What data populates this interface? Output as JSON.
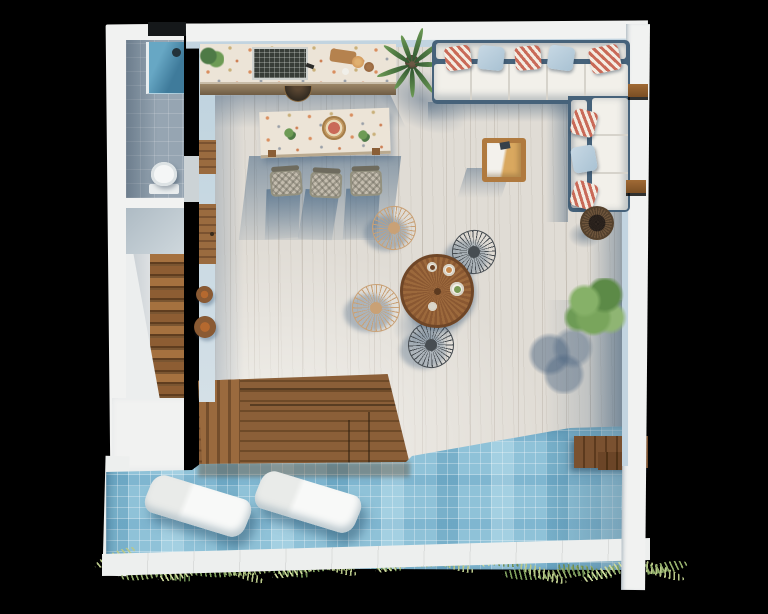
{
  "scene": {
    "title": "rooftop-terrace-floor-plan-render",
    "style": "top-down 3d architectural render on black background",
    "rooms": [
      "bathroom",
      "stairwell",
      "terrace",
      "pool"
    ],
    "objects": [
      "shower",
      "toilet",
      "staircase",
      "outdoor-kitchen-counter",
      "grill",
      "bar-table",
      "bar-stools",
      "l-shaped-sofa",
      "striped-pillows",
      "wood-armchair",
      "round-dining-table",
      "wire-fan-chairs",
      "basket-planter",
      "tree",
      "palm-plant",
      "deck-steps",
      "mosaic-pool",
      "pool-loungers",
      "pool-bench",
      "palm-fronds"
    ]
  },
  "palette": {
    "black": "#000000",
    "wall": "#f1f2f1",
    "wallFace": "#c2d4e0",
    "floor": "#e0dcd5",
    "bathFloor": "#96a5b2",
    "showerTeal": "#3f7b9b",
    "toilet": "#f4f6f6",
    "stairWood": "#a5713f",
    "doorWood": "#9a6b3f",
    "terrazzo": "#ece4d7",
    "grill": "#383d38",
    "sofaBase": "#46627a",
    "cushion": "#f2f0ea",
    "stripeRed": "#c96a58",
    "pillowBlue": "#a9c2d3",
    "armTan": "#d9a85f",
    "stoolGray": "#c3bcae",
    "tableWood": "#8a5832",
    "chairTan": "#c9a176",
    "chairDark": "#474d52",
    "treeGreen": "#79a55c",
    "basket": "#2f2620",
    "deck": "#8b5f38",
    "poolBase": "#8fc2d8",
    "benchWood": "#7a5130",
    "curb": "#edefee"
  },
  "build": {
    "stair_treads": {
      "count": 12,
      "step": 12,
      "height": 10
    },
    "palm_fronds": {
      "count": 9,
      "base_len": 26
    },
    "sofa_pillows_h": [
      {
        "x": 13,
        "t": "stripe",
        "rot": -8
      },
      {
        "x": 46,
        "t": "plain",
        "rot": 6
      },
      {
        "x": 83,
        "t": "stripe",
        "rot": -5
      },
      {
        "x": 116,
        "t": "plain",
        "rot": 8
      },
      {
        "x": 158,
        "t": "stripe",
        "rot": -12,
        "w": 30,
        "h": 26
      }
    ],
    "sofa_pillows_v": [
      {
        "y": 14,
        "t": "stripe",
        "rot": 14
      },
      {
        "y": 50,
        "t": "plain",
        "rot": -10
      },
      {
        "y": 86,
        "t": "stripe",
        "rot": 18
      }
    ],
    "sofa_seams_h": [
      38,
      76,
      114,
      152
    ],
    "sofa_seams_v": [
      38,
      76
    ],
    "bar_stools": [
      {
        "x": 270,
        "y": 166,
        "rot": -4
      },
      {
        "x": 310,
        "y": 168,
        "rot": 3
      },
      {
        "x": 350,
        "y": 166,
        "rot": -2
      }
    ],
    "dining_chairs": [
      {
        "x": 372,
        "y": 206,
        "c": "chairTan",
        "rot": -20,
        "s": 44
      },
      {
        "x": 352,
        "y": 284,
        "c": "chairTan",
        "rot": 35,
        "s": 48
      },
      {
        "x": 452,
        "y": 230,
        "c": "chairDark",
        "rot": 160,
        "s": 44
      },
      {
        "x": 408,
        "y": 322,
        "c": "chairDark",
        "rot": 110,
        "s": 46
      }
    ],
    "dining_items": [
      {
        "x": 443,
        "y": 264,
        "s": 12,
        "food": "#c98a4e"
      },
      {
        "x": 450,
        "y": 282,
        "s": 14,
        "food": "#7a9a55"
      },
      {
        "x": 427,
        "y": 262,
        "s": 10,
        "food": "#6e4426"
      },
      {
        "x": 428,
        "y": 302,
        "s": 9,
        "food": "#d9d5c9"
      }
    ],
    "floor_baskets": [
      {
        "x": 196,
        "y": 286,
        "s": 17
      },
      {
        "x": 194,
        "y": 316,
        "s": 22
      }
    ],
    "wall_brackets": [
      {
        "x": 628,
        "y": 84
      },
      {
        "x": 626,
        "y": 180
      }
    ],
    "deck_inner_steps": [
      {
        "x": 42,
        "y": 14,
        "w": 160,
        "h": 2
      },
      {
        "x": 52,
        "y": 30,
        "w": 152,
        "h": 2
      },
      {
        "x": 150,
        "y": 46,
        "w": 2,
        "h": 44
      },
      {
        "x": 170,
        "y": 38,
        "w": 2,
        "h": 52
      }
    ],
    "loungers": [
      {
        "x": 146,
        "y": 486
      },
      {
        "x": 256,
        "y": 482
      }
    ],
    "fronds": {
      "count": 27,
      "x0": 98,
      "dx": 21,
      "y0": 552,
      "colors": [
        "#b8c789",
        "#94ad6b",
        "#6d8c52",
        "#cdd99c",
        "#7fa05e"
      ]
    }
  }
}
